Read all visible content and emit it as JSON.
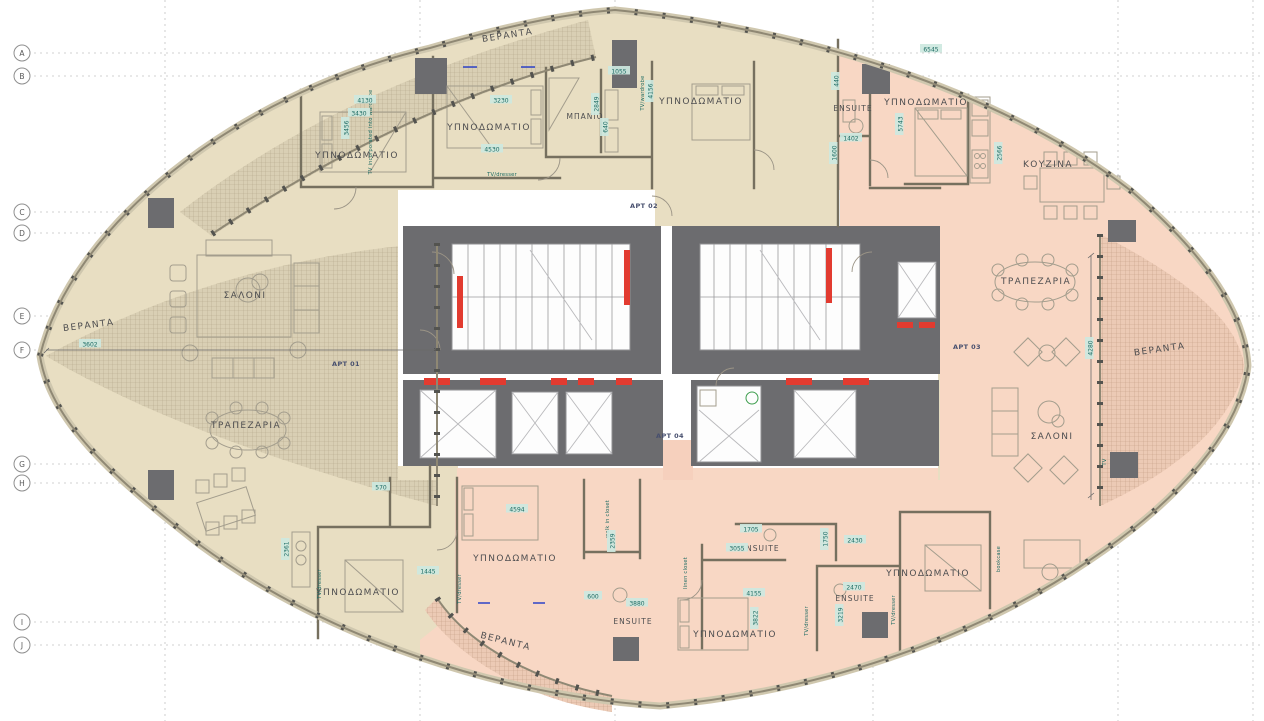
{
  "labels": {
    "bedroom": "ΥΠΝΟΔΩΜΑΤΙΟ",
    "bathroom": "ΜΠΑΝΙΟ",
    "ensuite": "ENSUITE",
    "kitchen": "ΚΟΥΖΙΝΑ",
    "living_room": "ΣΑΛΟΝΙ",
    "dining_room": "ΤΡΑΠΕΖΑΡΙΑ",
    "veranda": "ΒΕΡΑΝΤΑ"
  },
  "apartments": {
    "apt1": "APT 01",
    "apt2": "APT 02",
    "apt3": "APT 03",
    "apt4": "APT 04"
  },
  "grid_letters": [
    "A",
    "B",
    "C",
    "D",
    "E",
    "F",
    "G",
    "H",
    "I",
    "J"
  ],
  "annotations": {
    "tv_dresser": "TV/dresser",
    "tv_wardrobe": "TV/wardrobe",
    "tv_incorporated": "TV incorporated into wardrobe",
    "walk_in_closet": "walk in closet",
    "linen_closet": "linen closet",
    "bookcase": "bookcase",
    "tv": "TV"
  },
  "dims": {
    "a4130": "4130",
    "a3430": "3430",
    "a3456": "3456",
    "a3230": "3230",
    "a4530": "4530",
    "a1055": "1055",
    "a2849": "2849",
    "a640": "640",
    "a6545": "6545",
    "a4156": "4156",
    "a5743": "5743",
    "a2566": "2566",
    "a1402": "1402",
    "a1600": "1600",
    "a440": "440",
    "a3602": "3602",
    "a4280": "4280",
    "a4594": "4594",
    "a2359": "2359",
    "a3880": "3880",
    "a600": "600",
    "a1705": "1705",
    "a3055": "3055",
    "a4155": "4155",
    "a3822": "3822",
    "a2430": "2430",
    "a1750": "1750",
    "a2470": "2470",
    "a3219": "3219",
    "a1445": "1445",
    "a2361": "2361",
    "a570": "570"
  },
  "colors": {
    "apartment_left": "#e8dec2",
    "apartment_right": "#f8d7c4",
    "veranda_left": "#d9cfb4",
    "veranda_right": "#eccab5",
    "core_wall": "#6c6c6f",
    "fire_door": "#e23b30",
    "dimension": "#1d6b63"
  }
}
